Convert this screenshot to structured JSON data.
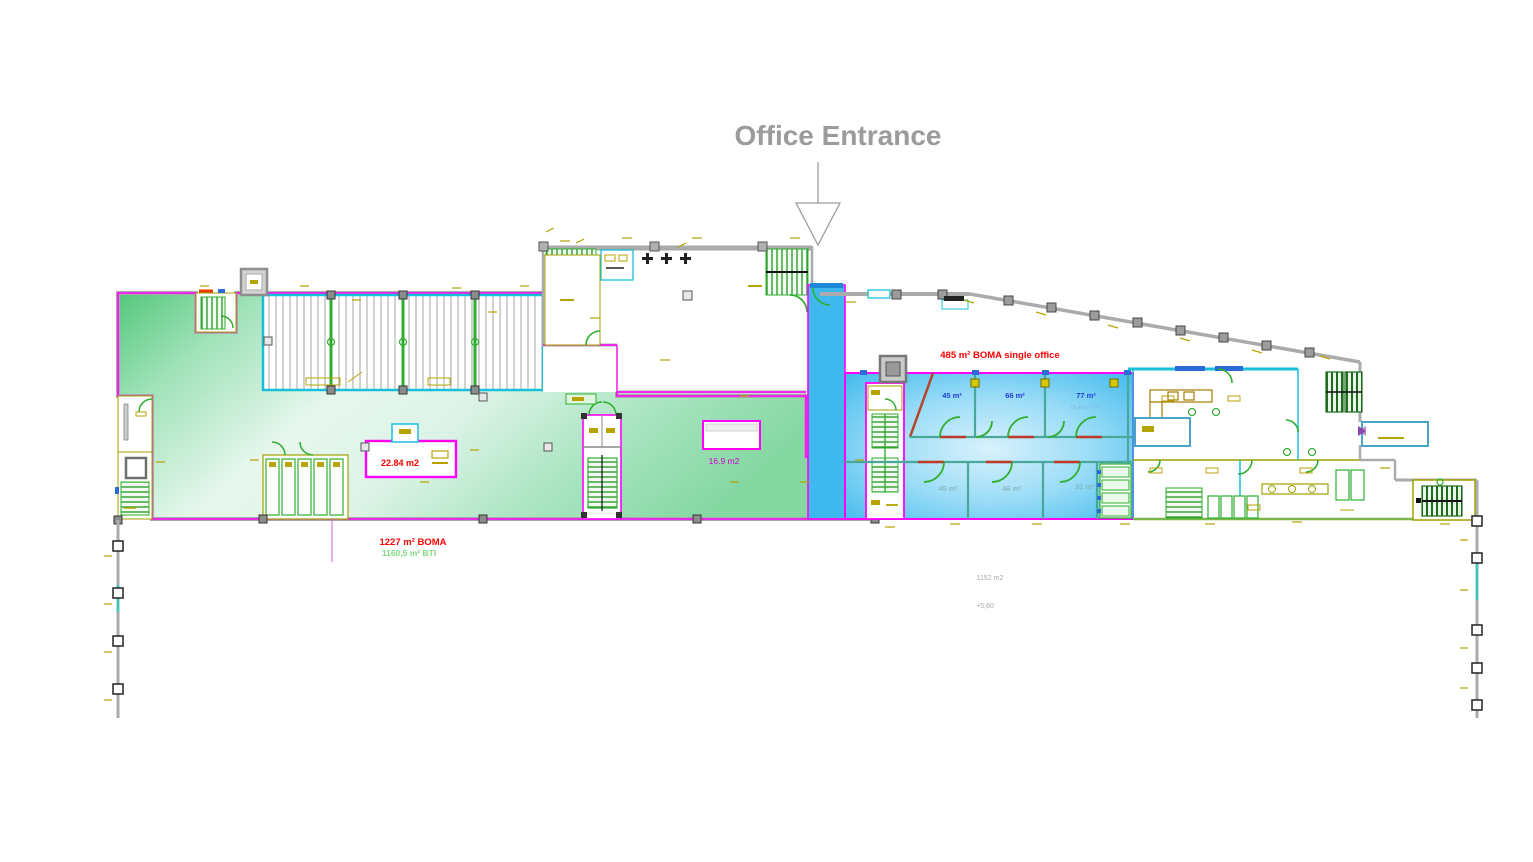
{
  "title": {
    "label": "Office Entrance"
  },
  "labels": {
    "single_office": "485 m² BOMA single office",
    "left_boma": "1227 m² BOMA",
    "left_bti": "1160,5 m² BTI",
    "room_small_a": "22.84 m2",
    "room_small_b": "16.9 m2",
    "area_note": "1152 m2",
    "level_note": "+5,60",
    "room77_sub": "73,48 m² BTI"
  },
  "rooms": {
    "top": [
      {
        "label": "45 m²"
      },
      {
        "label": "66 m²"
      },
      {
        "label": "77 m²"
      }
    ],
    "bottom": [
      {
        "label": "45 m²"
      },
      {
        "label": "46 m²"
      },
      {
        "label": "31 m²"
      }
    ]
  },
  "colors": {
    "tenant_boundary_magenta": "#ff00ff",
    "highlight_green": "#57c87e",
    "highlight_blue": "#2fb3ea",
    "wall_gray": "#ababab",
    "wall_cyan": "#18bfd8",
    "annotation_olive": "#b5a400",
    "fixture_green": "#2fae2f",
    "label_red": "#ff0000",
    "label_blue": "#1f3fd8",
    "label_green": "#7fd97f",
    "title_gray": "#9b9b9b"
  }
}
